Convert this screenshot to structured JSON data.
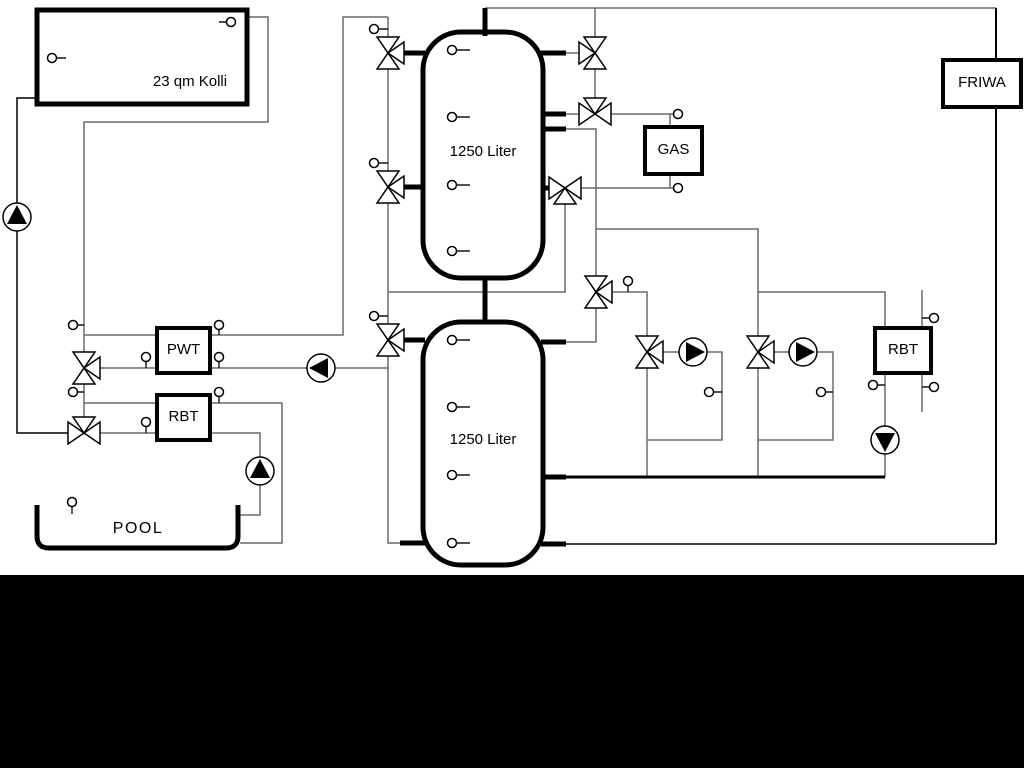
{
  "labels": {
    "collector": "23 qm Kolli",
    "tank_upper": "1250 Liter",
    "tank_lower": "1250 Liter",
    "gas": "GAS",
    "friwa": "FRIWA",
    "pwt": "PWT",
    "rbt_left": "RBT",
    "rbt_right": "RBT",
    "pool": "POOL"
  },
  "colors": {
    "thin_line": "#6a6a6a",
    "pipe": "#000000",
    "background": "#ffffff",
    "bottom_band": "#000000"
  },
  "components": {
    "pumps": [
      "solar-pump-up",
      "pwt-charge-pump-left",
      "heating-circuit-1-pump-right",
      "heating-circuit-2-pump-right",
      "rbt-right-pump-down",
      "pool-pump-up"
    ],
    "valves": [
      "riser-three-way-valve-top",
      "riser-three-way-valve-middle",
      "riser-three-way-valve-bottom",
      "tank-top-three-way-valve",
      "gas-flow-mixing-valve",
      "gas-return-three-way-valve",
      "tank-diverter-valve",
      "heating-circuit-1-mixing-valve",
      "heating-circuit-2-mixing-valve",
      "pwt-three-way-valve",
      "rbt-pool-three-way-valve"
    ]
  }
}
